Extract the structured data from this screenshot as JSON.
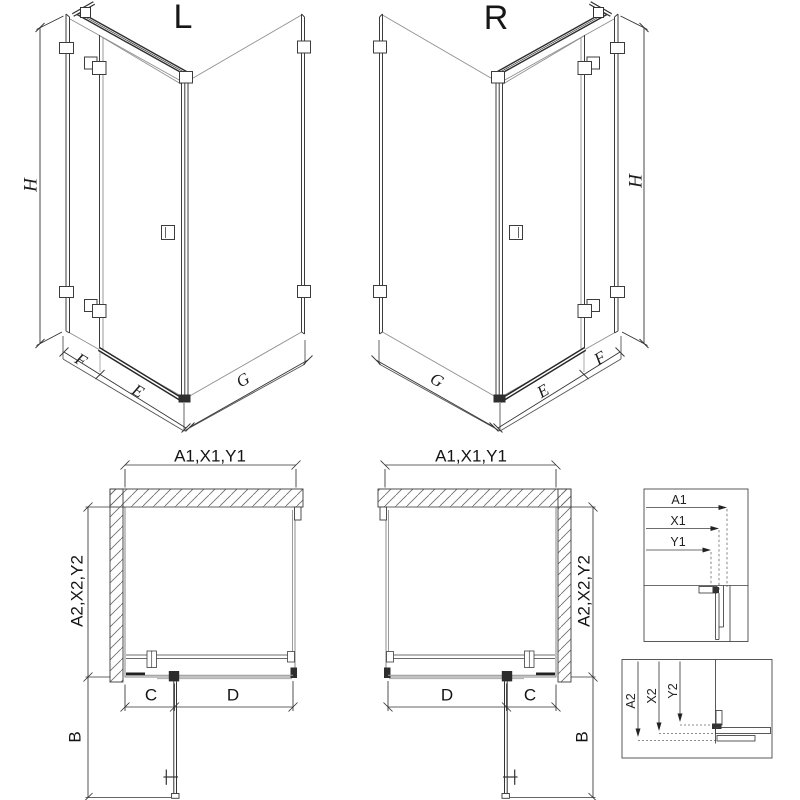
{
  "drawing": {
    "perspective_left": {
      "title": "L",
      "height_label": "H",
      "return_panel_label": "F",
      "door_label": "E",
      "side_panel_label": "G"
    },
    "perspective_right": {
      "title": "R",
      "height_label": "H",
      "return_panel_label": "F",
      "door_label": "E",
      "side_panel_label": "G"
    },
    "plan_left": {
      "width_label": "A1,X1,Y1",
      "depth_label": "A2,X2,Y2",
      "hinge_segment_label": "C",
      "door_segment_label": "D",
      "door_swing_label": "B"
    },
    "plan_right": {
      "width_label": "A1,X1,Y1",
      "depth_label": "A2,X2,Y2",
      "hinge_segment_label": "C",
      "door_segment_label": "D",
      "door_swing_label": "B"
    },
    "detail_width_box": {
      "rows": [
        "A1",
        "X1",
        "Y1"
      ]
    },
    "detail_depth_box": {
      "rows": [
        "A2",
        "X2",
        "Y2"
      ]
    }
  },
  "colors": {
    "background": "#ffffff",
    "line_dark": "#2e2e2e",
    "line_medium": "#3c3c3c",
    "line_light": "#8f8f8f",
    "hatch": "#6a6a6a"
  }
}
